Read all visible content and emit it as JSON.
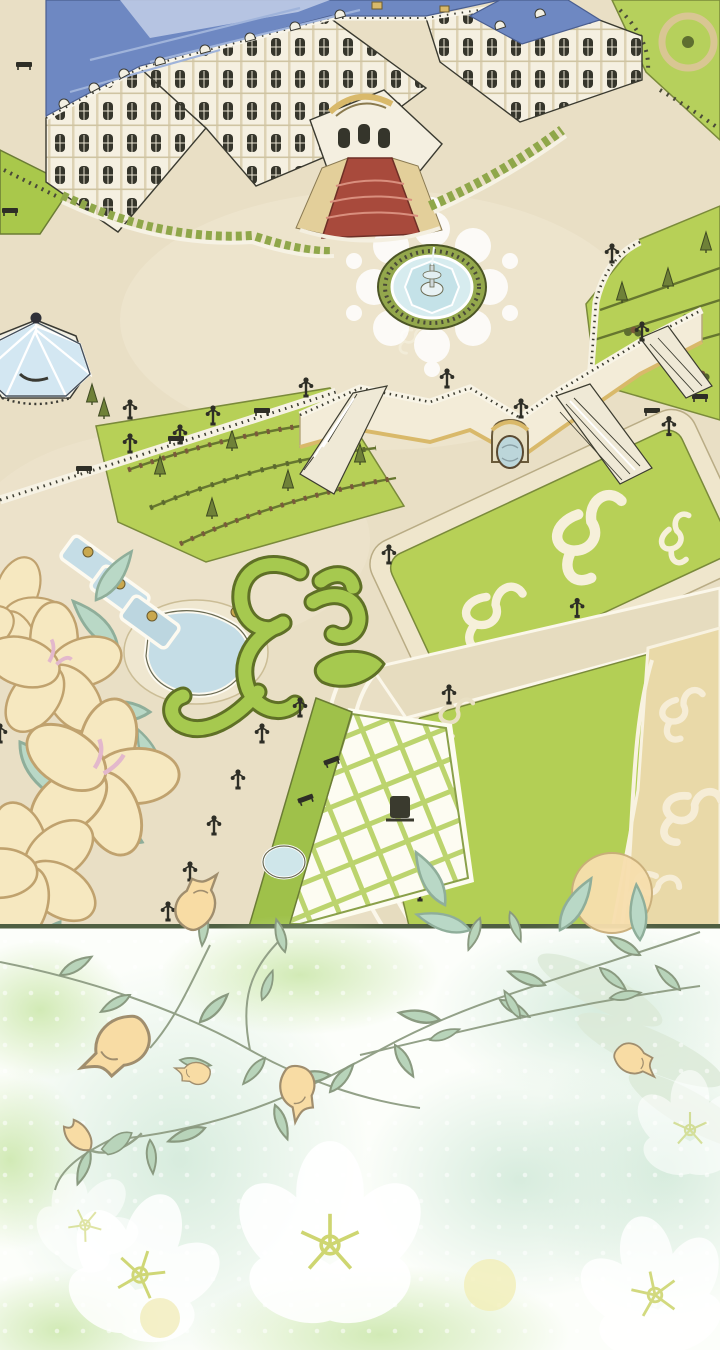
{
  "meta": {
    "description": "Aerial illustrated view of a baroque palace with blue mansard roof, formal gardens, fountain plaza, glass gazebo, terraced staircases, scroll parterres and a tiled court; below a soft floral transition panel with vine line-art, trumpet flowers and ghost white blossoms",
    "divider_y": 924
  },
  "palette": {
    "plaza_cream": "#e9dfc5",
    "plaza_light": "#f0e8d2",
    "roof_blue": "#6e88c2",
    "roof_blue_light": "#c3cfe8",
    "roof_ridge": "#9fb3da",
    "facade_white": "#f5f0e1",
    "facade_trim": "#d9b96a",
    "window_dark": "#35352b",
    "outline_dark": "#3a3a33",
    "carpet_red": "#a84a3c",
    "step_tan": "#e3cf9a",
    "lawn_green": "#b7d057",
    "lawn_edge": "#7a8a3a",
    "hedge_dark": "#5c6a2e",
    "tree_olive": "#6f8138",
    "water_blue": "#cfe6ea",
    "water_rim": "#ffffff",
    "path_tan": "#e6dcbf",
    "damask_cream": "#e9d9a8",
    "damask_motif": "#f6edd6",
    "topiary_green": "#a6c94f",
    "topiary_outline": "#5f7026",
    "tile_joint": "#bcd46e",
    "petal_cream": "#f6e8c0",
    "petal_outline": "#c0a26e",
    "leaf_teal": "#b9d8c6",
    "leaf_teal_outline": "#8fae9a",
    "divider_olive": "#4f5f42",
    "lower_bg": "#fcfefa",
    "wash_green": "#d9efc0",
    "wash_mint": "#dff0e4",
    "vine_stroke": "#93a188",
    "leaf_sage": "#b8d4ba",
    "leaf_sage_outline": "#8a9a80",
    "trumpet_peach": "#f8dca4",
    "trumpet_outline": "#a08e6e",
    "ghost_stamen": "#ccd46a",
    "glow_yellow": "#f2edb4"
  },
  "scene": {
    "upper_panel": {
      "label": "palace-garden-aerial",
      "elements": [
        "palace",
        "blue-mansard-roof",
        "entrance-red-carpet-stairs",
        "fountain-plaza",
        "glass-gazebo",
        "terrace-wall-staircases",
        "grotto-niche",
        "terraced-flower-rows",
        "right-slope-garden",
        "scroll-parterre",
        "arabesque-topiary",
        "cascade-pools",
        "tiled-court",
        "damask-lawn",
        "lamp-posts",
        "benches",
        "foreground-lily-flowers"
      ]
    },
    "lower_panel": {
      "label": "floral-transition",
      "elements": [
        "green-washes",
        "bokeh-dots",
        "vine-line-art",
        "sage-leaves",
        "trumpet-flowers",
        "tulip-flower",
        "ghost-white-flowers",
        "yellow-glows"
      ]
    }
  }
}
